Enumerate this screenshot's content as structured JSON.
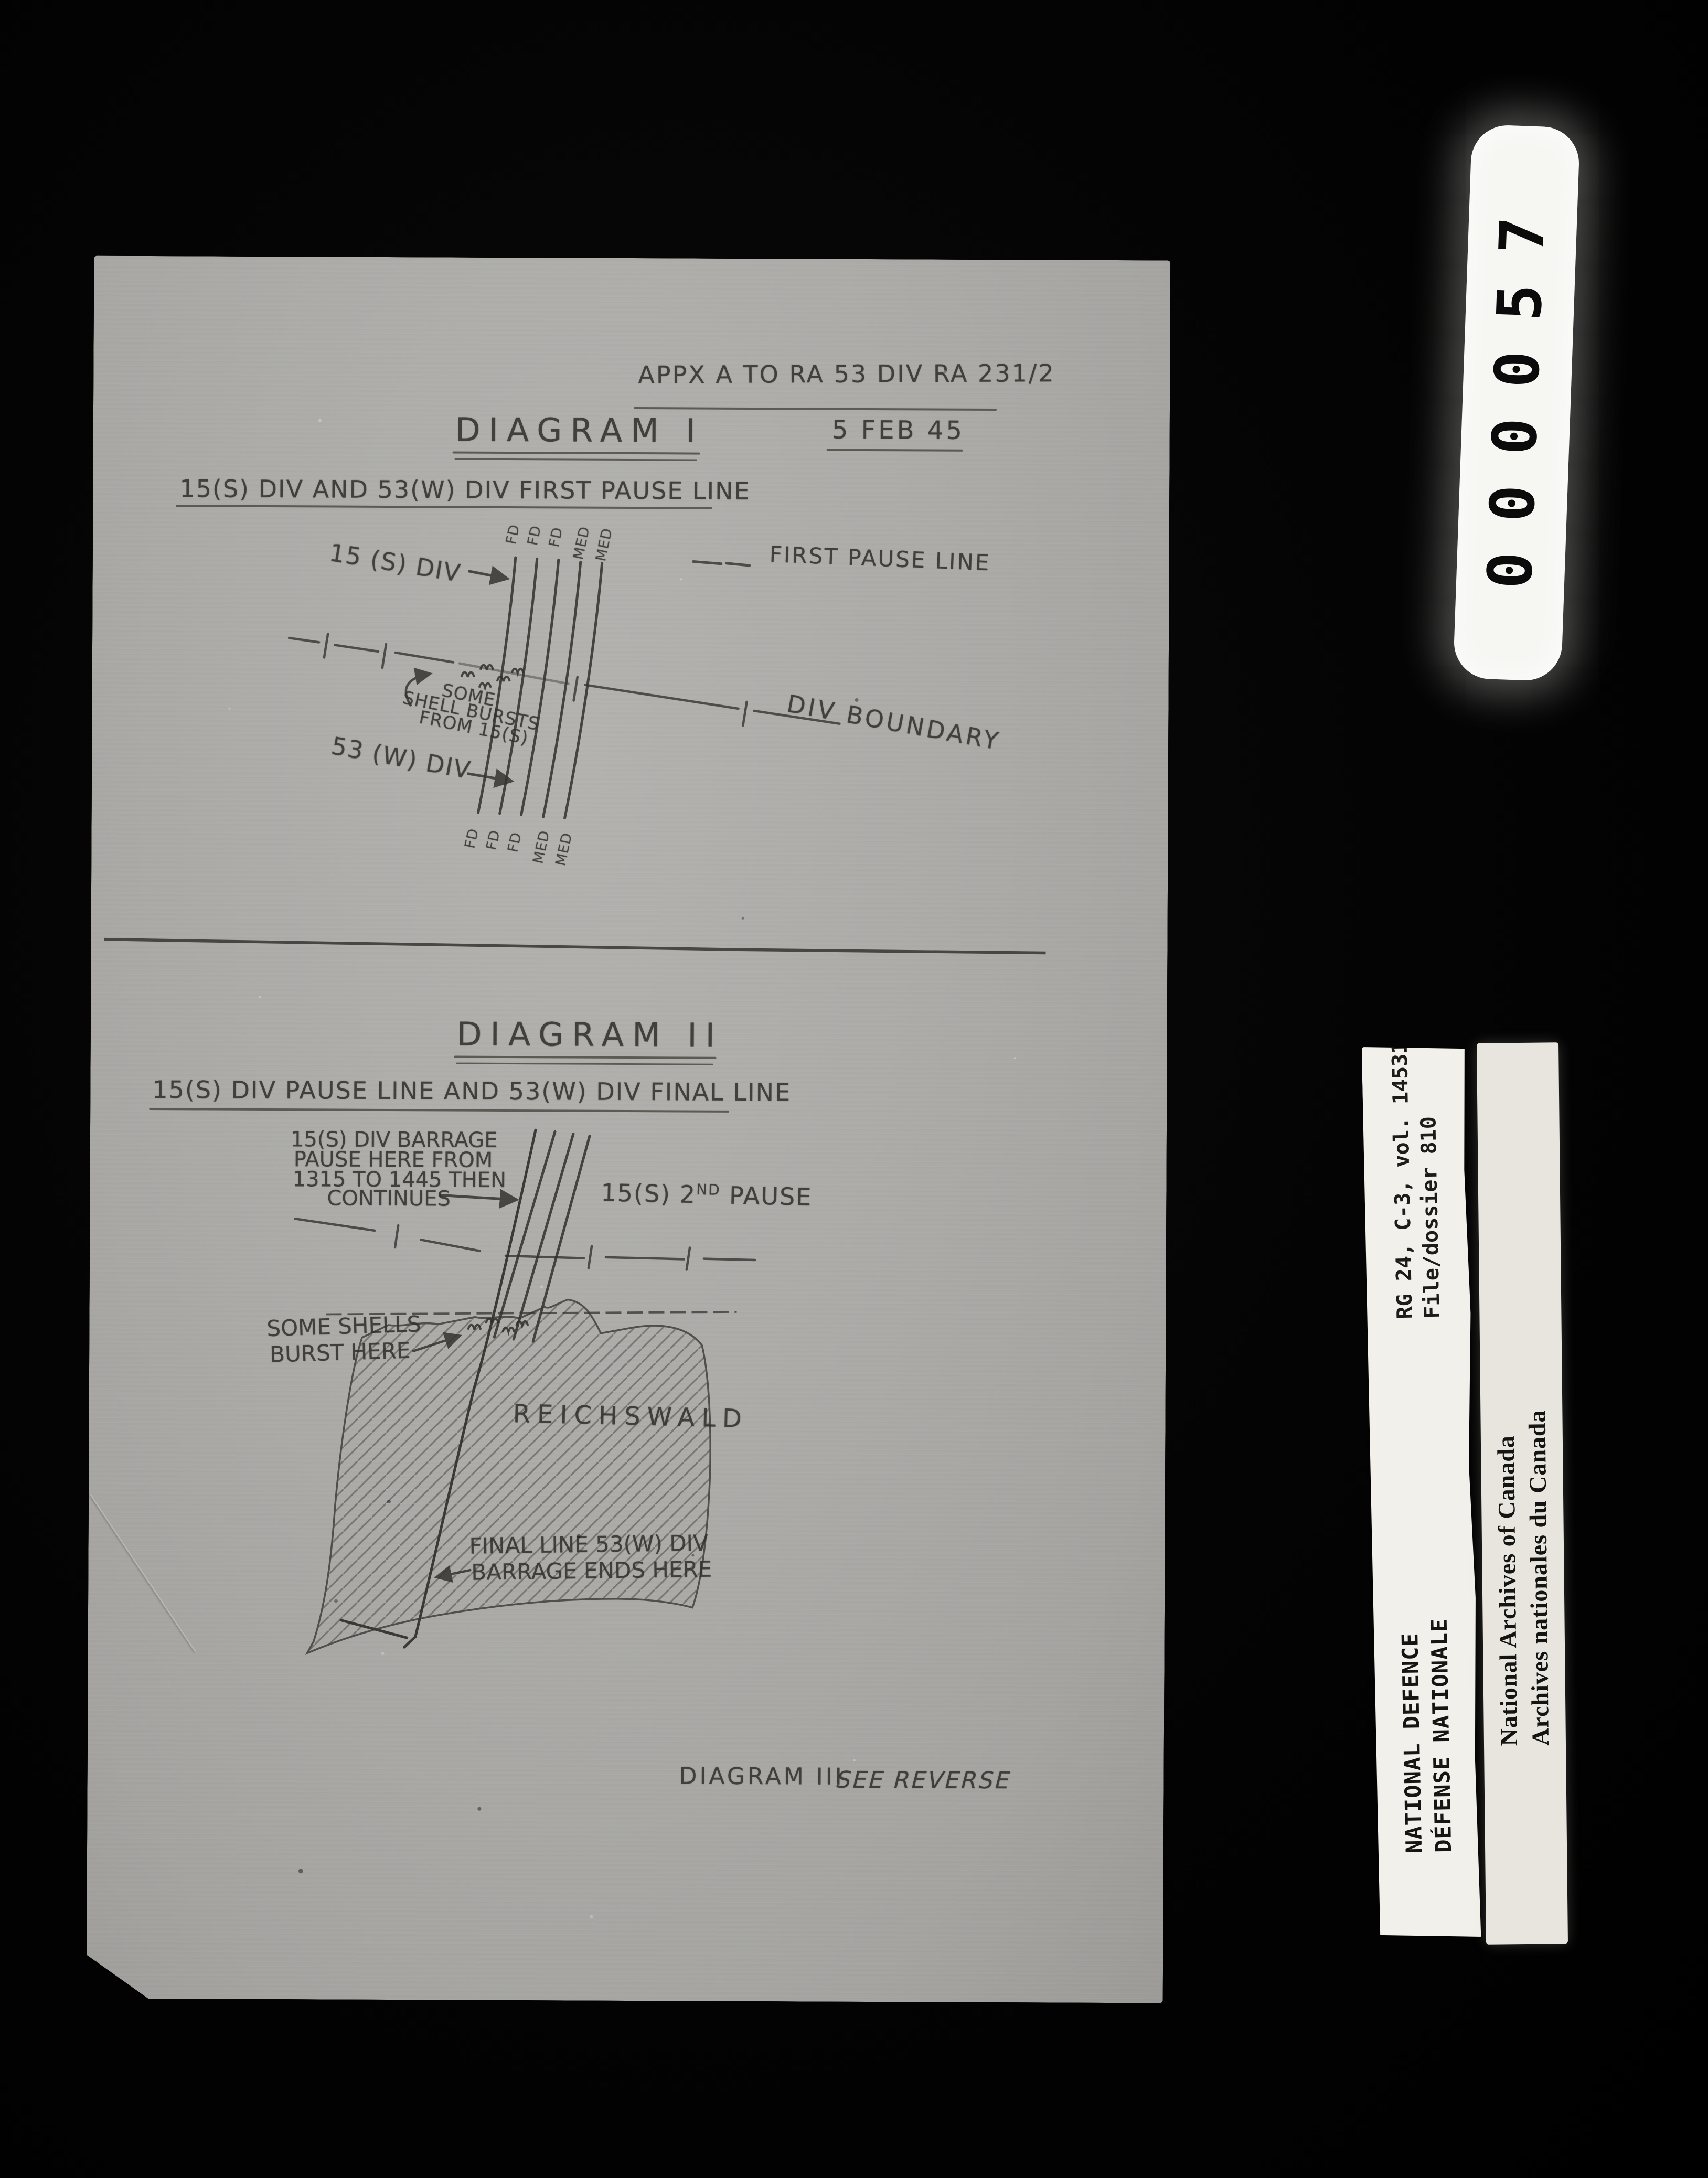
{
  "film": {
    "frame_number": "000057",
    "labels": {
      "rg_line1": "RG 24, C-3, vol. 14531",
      "rg_line2": "File/dossier 810",
      "defence_line1": "NATIONAL DEFENCE",
      "defence_line2": "DÉFENSE NATIONALE",
      "archives_line1": "National Archives of Canada",
      "archives_line2": "Archives nationales du Canada"
    }
  },
  "document": {
    "appendix_reference": "APPX A TO RA 53 DIV RA 231/2",
    "date": "5 FEB 45",
    "diagram1": {
      "title": "DIAGRAM I",
      "subtitle": "15(S) DIV AND 53(W) DIV FIRST PAUSE LINE",
      "lane_labels_top": [
        "FD",
        "FD",
        "FD",
        "MED",
        "MED"
      ],
      "lane_labels_bottom": [
        "FD",
        "FD",
        "FD",
        "MED",
        "MED"
      ],
      "label_15s": "15 (S) DIV",
      "legend_first_pause_line": "FIRST PAUSE LINE",
      "shell_bursts_note_lines": [
        "SOME",
        "SHELL BURSTS",
        "FROM 15(S)"
      ],
      "label_53w": "53 (W) DIV",
      "label_div_boundary": "DIV BOUNDARY"
    },
    "diagram2": {
      "title": "DIAGRAM II",
      "subtitle": "15(S) DIV PAUSE LINE AND 53(W) DIV FINAL LINE",
      "pause_note_lines": [
        "15(S) DIV BARRAGE",
        "PAUSE HERE FROM",
        "1315 TO 1445 THEN",
        "CONTINUES"
      ],
      "second_pause_prefix": "15(S) 2",
      "second_pause_sup": "ND",
      "second_pause_suffix": " PAUSE",
      "shells_note_lines": [
        "SOME SHELLS",
        "BURST HERE"
      ],
      "forest_name": "REICHSWALD",
      "final_line_note_lines": [
        "FINAL LINE 53(W) DIV",
        "BARRAGE ENDS HERE"
      ]
    },
    "footer": {
      "diagram3_label": "DIAGRAM III",
      "see_reverse": "SEE REVERSE"
    }
  },
  "colors": {
    "film_background": "#000000",
    "paper": "#abaaa7",
    "ink": "#32312d",
    "label_white": "#f1f0ea",
    "label_grey": "#e7e5de"
  }
}
